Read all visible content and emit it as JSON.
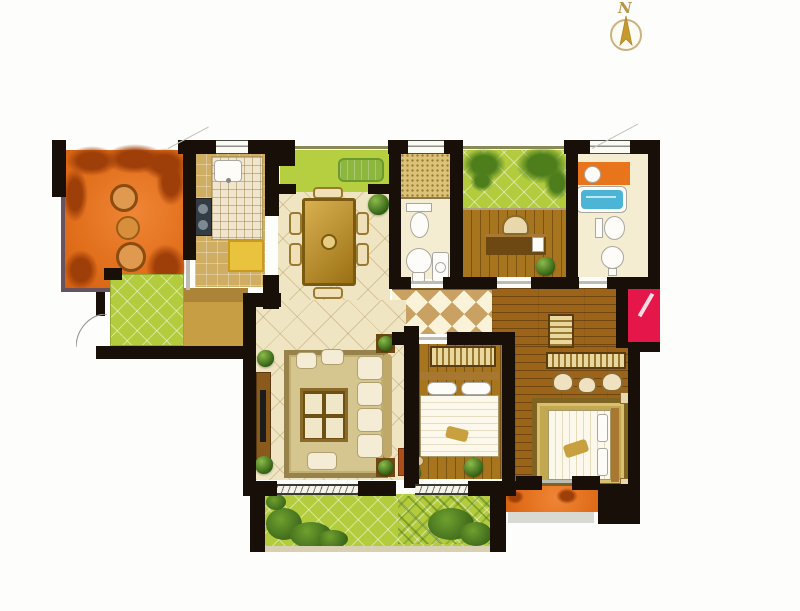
{
  "compass": {
    "label": "N"
  },
  "palette": {
    "wall": "#181008",
    "balcony_orange": "#e2701d",
    "foliage_red": "#9e3e08",
    "balcony_green": "#b2cc3e",
    "foliage_green": "#4e7e1c",
    "floor_cream": "#f0e5c2",
    "floor_wood": "#9c6418",
    "floor_wood_light": "#a8751f",
    "hall_tile_tan": "#c9a163",
    "counter_cream": "#efe6cd",
    "dining_table_gold": "#b8892f",
    "bathtub_blue": "#4cb4d4",
    "red_unit": "#e5164a",
    "fridge_yellow": "#eac33e",
    "ledge_gray": "#d9d9d3",
    "background": "#ffffff"
  },
  "diagram": {
    "type": "residential floor plan",
    "rooms": [
      {
        "name": "northwest balcony",
        "floor": "orange terrace",
        "features": [
          "rattan chairs",
          "round table",
          "planting"
        ]
      },
      {
        "name": "kitchen",
        "floor": "tile",
        "features": [
          "sink",
          "stove",
          "counter",
          "refrigerator"
        ]
      },
      {
        "name": "north balcony",
        "floor": "green",
        "features": [
          "bench"
        ]
      },
      {
        "name": "dining room",
        "floor": "cream tile",
        "features": [
          "dining table",
          "six chairs",
          "plant"
        ]
      },
      {
        "name": "guest bathroom",
        "floor": "cream tile",
        "features": [
          "shower",
          "toilet",
          "basin",
          "washer"
        ]
      },
      {
        "name": "study balcony",
        "floor": "green",
        "features": [
          "planting"
        ]
      },
      {
        "name": "study",
        "floor": "wood",
        "features": [
          "desk",
          "computer",
          "chair",
          "plant"
        ]
      },
      {
        "name": "master bathroom",
        "floor": "cream tile",
        "features": [
          "vanity",
          "bathtub",
          "toilet",
          "basin"
        ]
      },
      {
        "name": "entry garden",
        "floor": "green"
      },
      {
        "name": "entry foyer",
        "floor": "tan tile"
      },
      {
        "name": "living room",
        "floor": "cream tile",
        "features": [
          "sofa set",
          "coffee table",
          "rug",
          "tv cabinet",
          "plants"
        ]
      },
      {
        "name": "entry hallway",
        "floor": "diamond tile"
      },
      {
        "name": "second bedroom",
        "floor": "wood",
        "features": [
          "bed",
          "wardrobe",
          "dresser",
          "stool",
          "plant"
        ]
      },
      {
        "name": "master bedroom",
        "floor": "wood",
        "features": [
          "bed",
          "rug",
          "wardrobe",
          "dresser",
          "stools"
        ]
      },
      {
        "name": "south balcony",
        "floor": "green",
        "features": [
          "shrubs",
          "trellis"
        ]
      },
      {
        "name": "southeast balcony",
        "floor": "orange terrace"
      },
      {
        "name": "utility red cabinet",
        "floor": "red"
      }
    ]
  }
}
